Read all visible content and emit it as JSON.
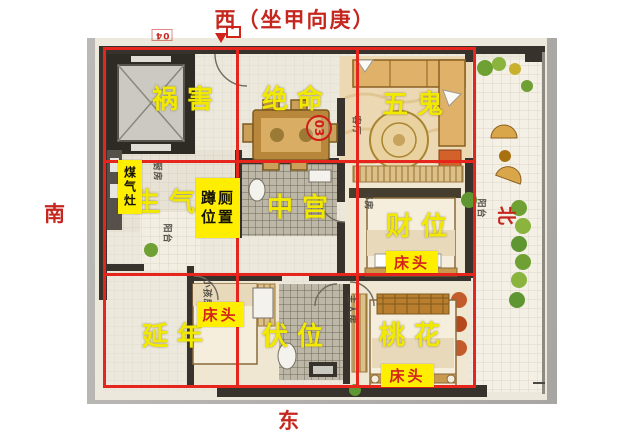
{
  "compass": {
    "west_title": "西（坐甲向庚）",
    "south": "南",
    "east": "东",
    "north": "北"
  },
  "sectors": {
    "nw": "祸害",
    "n": "绝命",
    "ne": "五鬼",
    "w": "生气",
    "c": "中宫",
    "e": "财位",
    "sw": "延年",
    "s": "伏位",
    "se": "桃花"
  },
  "tags": {
    "gas_stove": "煤气灶",
    "squat_line1": "蹲厕",
    "squat_line2": "位置",
    "bed_head": "床头"
  },
  "marks": {
    "unit_badge": "03",
    "unit_number": "04"
  },
  "rooms": {
    "kitchen": "厨房",
    "kitchen_balcony": "阳台",
    "living": "客厅",
    "study": "书房",
    "balcony": "阳台",
    "kids": "小孩房",
    "master": "主人房"
  },
  "colors": {
    "grid_red": "#e6251c",
    "sector_yellow": "#f2e900",
    "tag_yellow": "#ffee00",
    "tag_red_text": "#d3231c",
    "direction_red": "#c5271f"
  }
}
